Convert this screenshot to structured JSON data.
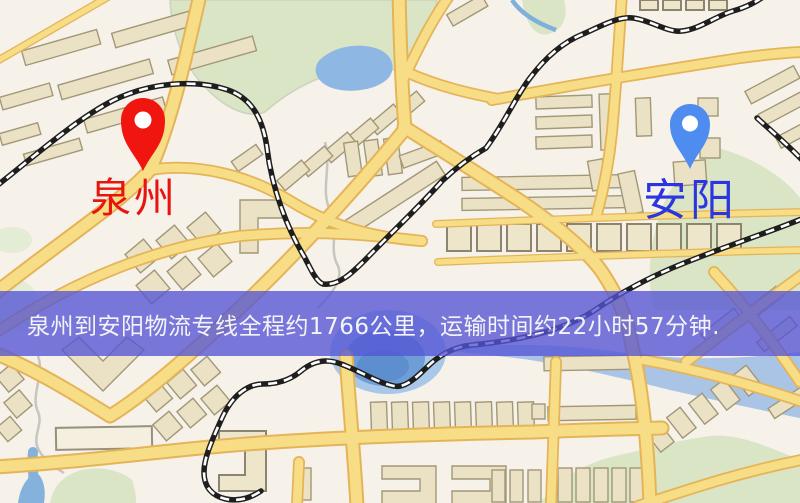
{
  "map": {
    "palette": {
      "background": "#f6f1e9",
      "park_green": "#d9e5c4",
      "water_blue": "#8fb7e3",
      "road_yellow": "#f7dd86",
      "road_casing": "#e5b458",
      "building_beige": "#ebe2c6",
      "railway_black": "#1e1e1e"
    }
  },
  "markers": {
    "origin": {
      "label": "泉州",
      "pin_color": "#f0150f",
      "label_color": "#e8140f"
    },
    "destination": {
      "label": "安阳",
      "pin_color": "#4e8cf0",
      "label_color": "#2b36e0"
    }
  },
  "banner": {
    "text": "泉州到安阳物流专线全程约1766公里，运输时间约22小时57分钟.",
    "background": "#5454d5",
    "text_color": "#f4f4f8"
  },
  "route": {
    "origin": "泉州",
    "destination": "安阳",
    "distance": "1766公里",
    "duration": "22小时57分钟"
  }
}
